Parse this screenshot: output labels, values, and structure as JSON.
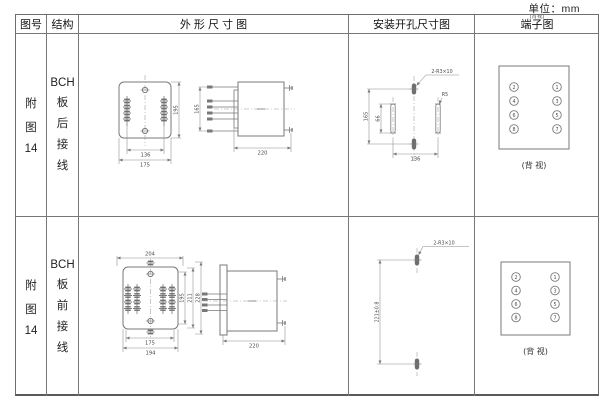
{
  "unit_label": "单位：mm",
  "headers": {
    "fig_no": "图号",
    "structure": "结构",
    "outline": "外 形 尺 寸 图",
    "install": "安装开孔尺寸图",
    "terminal": "端子图",
    "terminal_note": "(背视)"
  },
  "rows": [
    {
      "fig_no": [
        "附",
        "图",
        "14"
      ],
      "structure": [
        "BCH",
        "板",
        "后",
        "接",
        "线"
      ],
      "outline": {
        "front_height": "195",
        "pin_span": "165",
        "hole_spacing": "136",
        "body_width": "175",
        "depth": "220"
      },
      "install": {
        "holes_label": "2-R3×10",
        "slot_radius": "R5",
        "hole_span": "165",
        "slot_length": "66",
        "slot_spacing": "136"
      },
      "terminal": {
        "left": [
          "2",
          "4",
          "6",
          "8"
        ],
        "right": [
          "1",
          "3",
          "5",
          "7"
        ],
        "caption": "(背 视)"
      }
    },
    {
      "fig_no": [
        "附",
        "图",
        "14"
      ],
      "structure": [
        "BCH",
        "板",
        "前",
        "接",
        "线"
      ],
      "outline": {
        "flange_width": "204",
        "height_1": "195",
        "height_2": "211",
        "height_3": "228",
        "hole_spacing": "175",
        "body_width": "194",
        "depth": "220"
      },
      "install": {
        "holes_label": "2-R3×10",
        "hole_span": "221±0.8"
      },
      "terminal": {
        "left": [
          "2",
          "4",
          "6",
          "8"
        ],
        "right": [
          "1",
          "3",
          "5",
          "7"
        ],
        "caption": "(背 视)"
      }
    }
  ],
  "colors": {
    "object_line": "#787878",
    "dimension_line": "#8a8a8a",
    "text": "#333333",
    "border": "#6e6e6e"
  }
}
